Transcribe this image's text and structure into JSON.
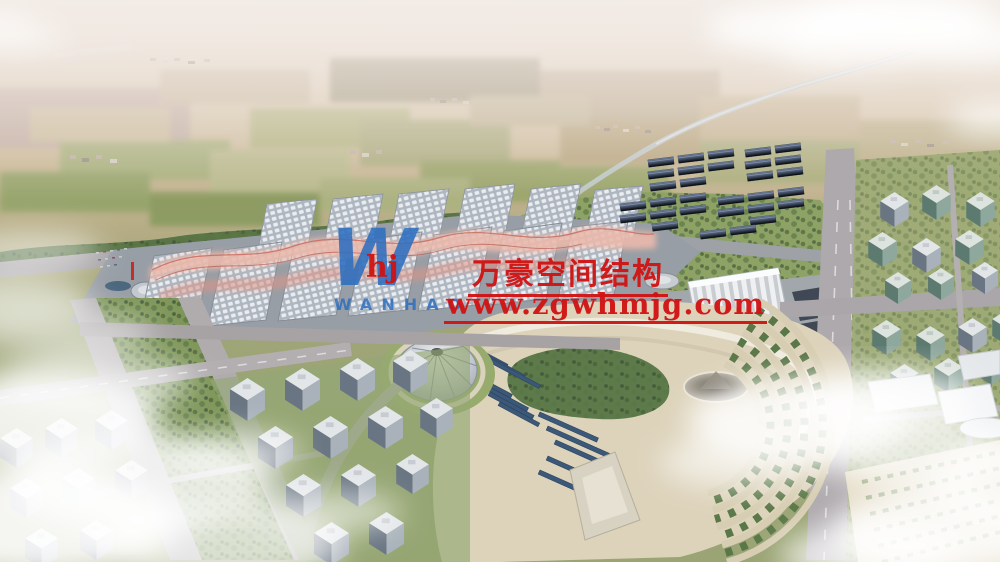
{
  "image": {
    "type": "architectural-aerial-rendering",
    "subject": "Bird's-eye rendering of a large exhibition-center complex (barrel-vault halls with pink membrane canopies), solar-shed fields, landscaped park with circular tent and crater garden, surrounding city blocks, farmland plain and hazy horizon with clouds"
  },
  "watermark": {
    "logo_letter": "W",
    "logo_monogram": "hj",
    "logo_wordmark": "WANHAO",
    "company_name_cn": "万豪空间结构",
    "website": "www.zgwhmjg.com",
    "red": "#d01212",
    "blue": "#2e6fc0"
  },
  "palette": {
    "haze": "#ece4dc",
    "farmland_tan": "#c9b795",
    "farmland_green": "#9aa96e",
    "tree_green": "#55703f",
    "road_grey": "#aaa6a8",
    "hall_roof": "#b6bdc6",
    "hall_canopy": "#e7b3a8",
    "shed_dark": "#46526a",
    "park_ground": "#ddd3bb",
    "solar_panel": "#3c5878",
    "building_face": "#6e7a86",
    "cloud_white": "#ffffff"
  }
}
